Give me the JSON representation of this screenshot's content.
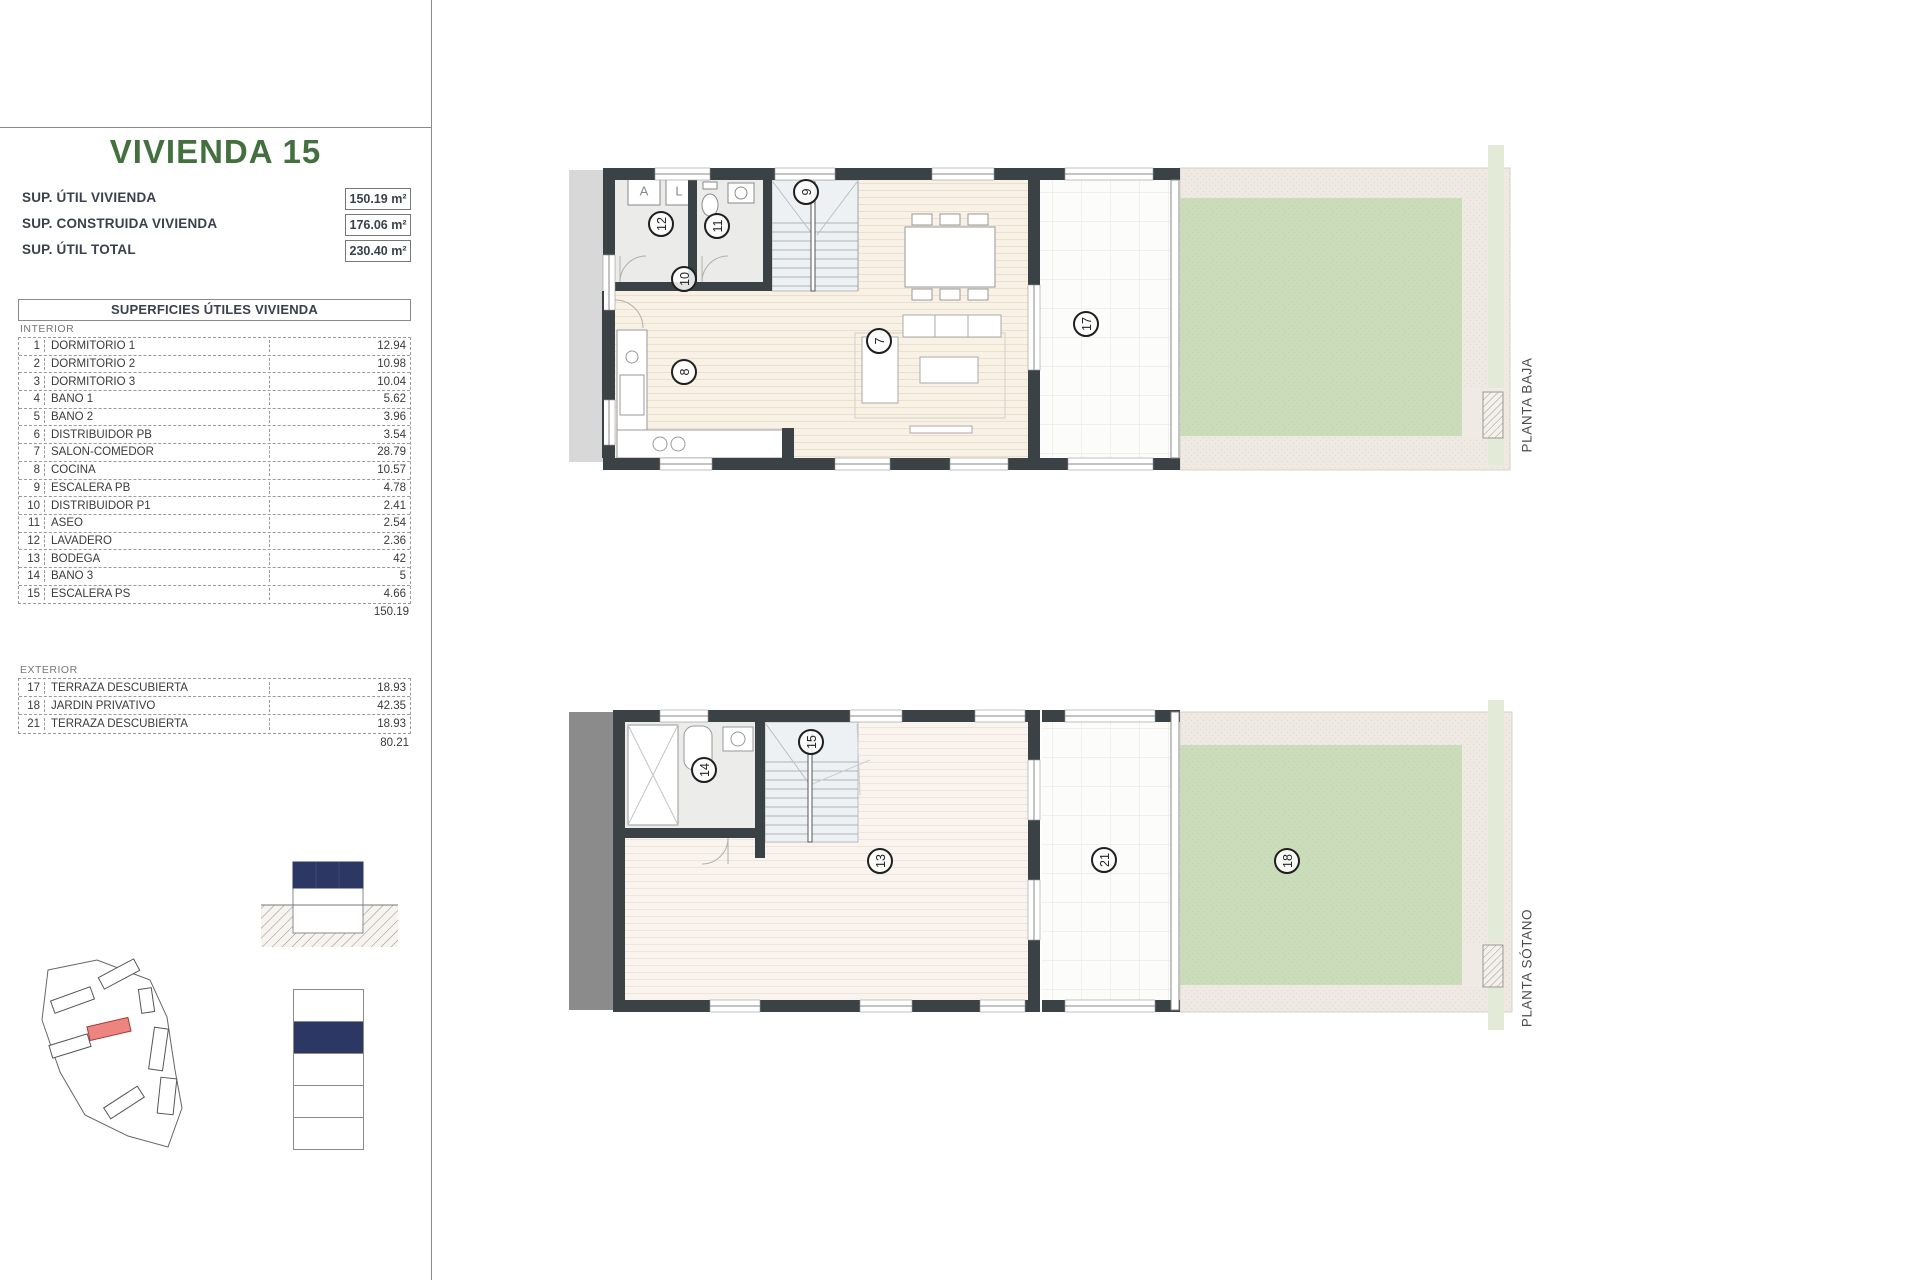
{
  "sheet": {
    "title": "VIVIENDA 15",
    "summary": [
      {
        "label": "SUP. ÚTIL VIVIENDA",
        "value": "150.19 m²"
      },
      {
        "label": "SUP. CONSTRUIDA VIVIENDA",
        "value": "176.06 m²"
      },
      {
        "label": "SUP. ÚTIL TOTAL",
        "value": "230.40 m²"
      }
    ],
    "table": {
      "header": "SUPERFICIES ÚTILES VIVIENDA",
      "interior_label": "INTERIOR",
      "interior_rows": [
        {
          "n": "1",
          "name": "DORMITORIO 1",
          "value": "12.94"
        },
        {
          "n": "2",
          "name": "DORMITORIO 2",
          "value": "10.98"
        },
        {
          "n": "3",
          "name": "DORMITORIO 3",
          "value": "10.04"
        },
        {
          "n": "4",
          "name": "BAÑO 1",
          "value": "5.62"
        },
        {
          "n": "5",
          "name": "BAÑO 2",
          "value": "3.96"
        },
        {
          "n": "6",
          "name": "DISTRIBUIDOR PB",
          "value": "3.54"
        },
        {
          "n": "7",
          "name": "SALÓN-COMEDOR",
          "value": "28.79"
        },
        {
          "n": "8",
          "name": "COCINA",
          "value": "10.57"
        },
        {
          "n": "9",
          "name": "ESCALERA PB",
          "value": "4.78"
        },
        {
          "n": "10",
          "name": "DISTRIBUIDOR P1",
          "value": "2.41"
        },
        {
          "n": "11",
          "name": "ASEO",
          "value": "2.54"
        },
        {
          "n": "12",
          "name": "LAVADERO",
          "value": "2.36"
        },
        {
          "n": "13",
          "name": "BODEGA",
          "value": "42"
        },
        {
          "n": "14",
          "name": "BAÑO 3",
          "value": "5"
        },
        {
          "n": "15",
          "name": "ESCALERA PS",
          "value": "4.66"
        }
      ],
      "interior_total": "150.19",
      "exterior_label": "EXTERIOR",
      "exterior_rows": [
        {
          "n": "17",
          "name": "TERRAZA DESCUBIERTA",
          "value": "18.93"
        },
        {
          "n": "18",
          "name": "JARDÍN PRIVATIVO",
          "value": "42.35"
        },
        {
          "n": "21",
          "name": "TERRAZA DESCUBIERTA",
          "value": "18.93"
        }
      ],
      "exterior_total": "80.21"
    },
    "plans": {
      "baja": {
        "label": "PLANTA BAJA",
        "markers": [
          "12",
          "11",
          "9",
          "10",
          "8",
          "7",
          "17"
        ],
        "appliances": {
          "washer": "A",
          "laundry": "L"
        }
      },
      "sotano": {
        "label": "PLANTA SÓTANO",
        "markers": [
          "14",
          "15",
          "13",
          "21",
          "18"
        ]
      }
    },
    "colors": {
      "title_green": "#44703f",
      "navy": "#2c3763",
      "highlight_red": "#ee8480",
      "garden_green": "#cbdcba",
      "wall_dark": "#3b4245",
      "floor_beige": "#f8f1e6",
      "gravel": "#efe9e3",
      "earth_gray": "#8b8b8b"
    }
  }
}
